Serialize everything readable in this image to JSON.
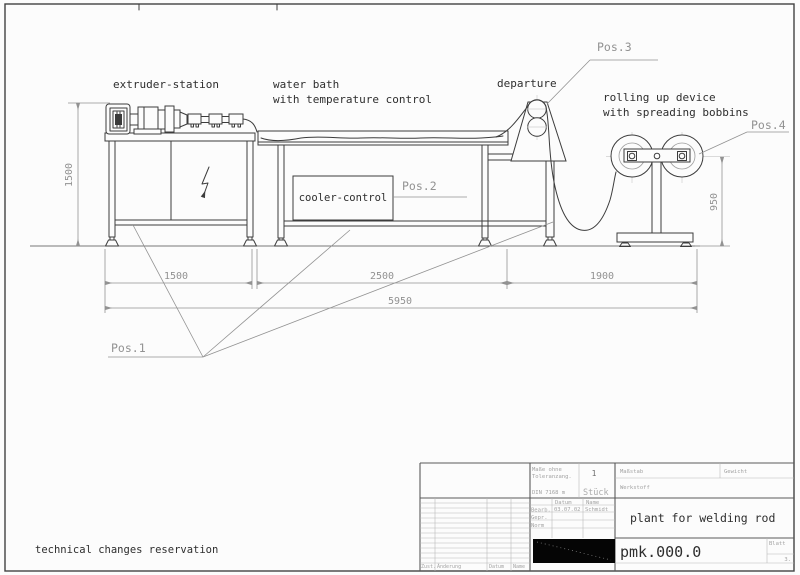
{
  "colors": {
    "paper": "#fcfcfc",
    "ink": "#3c3c3c",
    "dim": "#929292",
    "label": "#2e2e2e"
  },
  "drawing": {
    "labels": {
      "extruder_station": "extruder-station",
      "water_bath_line1": "water bath",
      "water_bath_line2": "with temperature control",
      "departure": "departure",
      "rollup_line1": "rolling up device",
      "rollup_line2": "with spreading bobbins",
      "cooler_control": "cooler-control",
      "footnote": "technical changes reservation"
    },
    "positions": {
      "pos1": "Pos.1",
      "pos2": "Pos.2",
      "pos3": "Pos.3",
      "pos4": "Pos.4"
    },
    "dimensions": {
      "station_height": "1500",
      "extruder_width": "1500",
      "water_bath_width": "2500",
      "rollup_width": "1900",
      "total_width": "5950",
      "rollup_height": "950"
    }
  },
  "title_block": {
    "tolerance_line1": "Maße ohne",
    "tolerance_line2": "Toleranzang.",
    "tolerance_norm": "DIN 7168 m",
    "quantity_value": "1",
    "quantity_unit": "Stück",
    "scale_label": "Maßstab",
    "material_label": "Werkstoff",
    "weight_label": "Gewicht",
    "col_date": "Datum",
    "col_name": "Name",
    "row_created": "Bearb.",
    "row_checked": "Gepr.",
    "row_norm": "Norm",
    "created_date": "03.07.02",
    "created_name": "Schmidt",
    "title": "plant for welding rod",
    "drawing_number": "pmk.000.0",
    "sheet_label": "Blatt",
    "sheet_value": "3.",
    "rev_state": "Zust.",
    "rev_change": "Änderung",
    "rev_date": "Datum",
    "rev_name": "Name"
  }
}
